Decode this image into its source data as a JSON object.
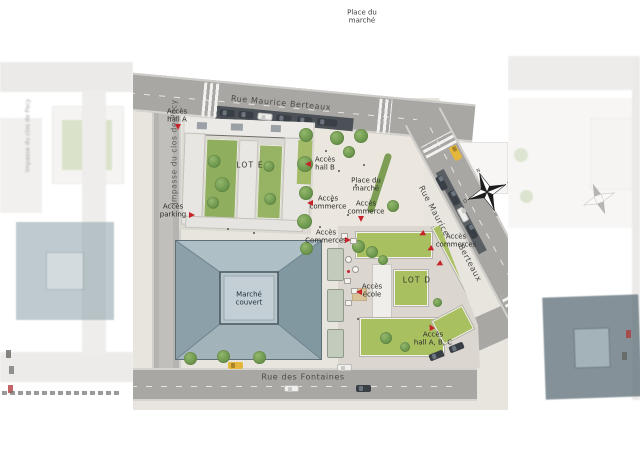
{
  "plan": {
    "top_area": {
      "l1": "Place du",
      "l2": "marché"
    },
    "streets": {
      "maurice_berteaux_top": "Rue Maurice Berteaux",
      "maurice_berteaux_right_1": "Rue Maurice",
      "maurice_berteaux_right_2": "Berteaux",
      "fontaines": "Rue des Fontaines",
      "impasse": "Impasse du clos de Pacy"
    },
    "places": {
      "place_marche_1": "Place du",
      "place_marche_2": "marché",
      "marche_couvert_1": "Marché",
      "marche_couvert_2": "couvert",
      "lot_e": "LOT E",
      "lot_d": "LOT D"
    },
    "access": {
      "hall_a": {
        "l1": "Accès",
        "l2": "hall A"
      },
      "hall_b": {
        "l1": "Accès",
        "l2": "hall B"
      },
      "commerce_w": {
        "l1": "Accès",
        "l2": "commerce"
      },
      "commerce_mid": {
        "l1": "Accès",
        "l2": "commerce"
      },
      "commerces_marche": {
        "l1": "Accès",
        "l2": "Commerces"
      },
      "parking": {
        "l1": "Accès",
        "l2": "parking"
      },
      "ecole": {
        "l1": "Accès",
        "l2": "école"
      },
      "commerces_right": {
        "l1": "Accès",
        "l2": "commerces"
      },
      "hall_abc": {
        "l1": "Accès",
        "l2": "hall A, B, C"
      }
    },
    "compass": {
      "n": "N",
      "e": "E",
      "s": "S",
      "o": "O"
    }
  },
  "colors": {
    "accent_red": "#c8232b",
    "road_gray": "#a9a7a4",
    "ground": "#e8e5df",
    "market_roof": "#8ba0a9",
    "lawn_green": "#a9c060",
    "tree_green": "#6f9a4f",
    "label_dark": "#2b2b28"
  }
}
